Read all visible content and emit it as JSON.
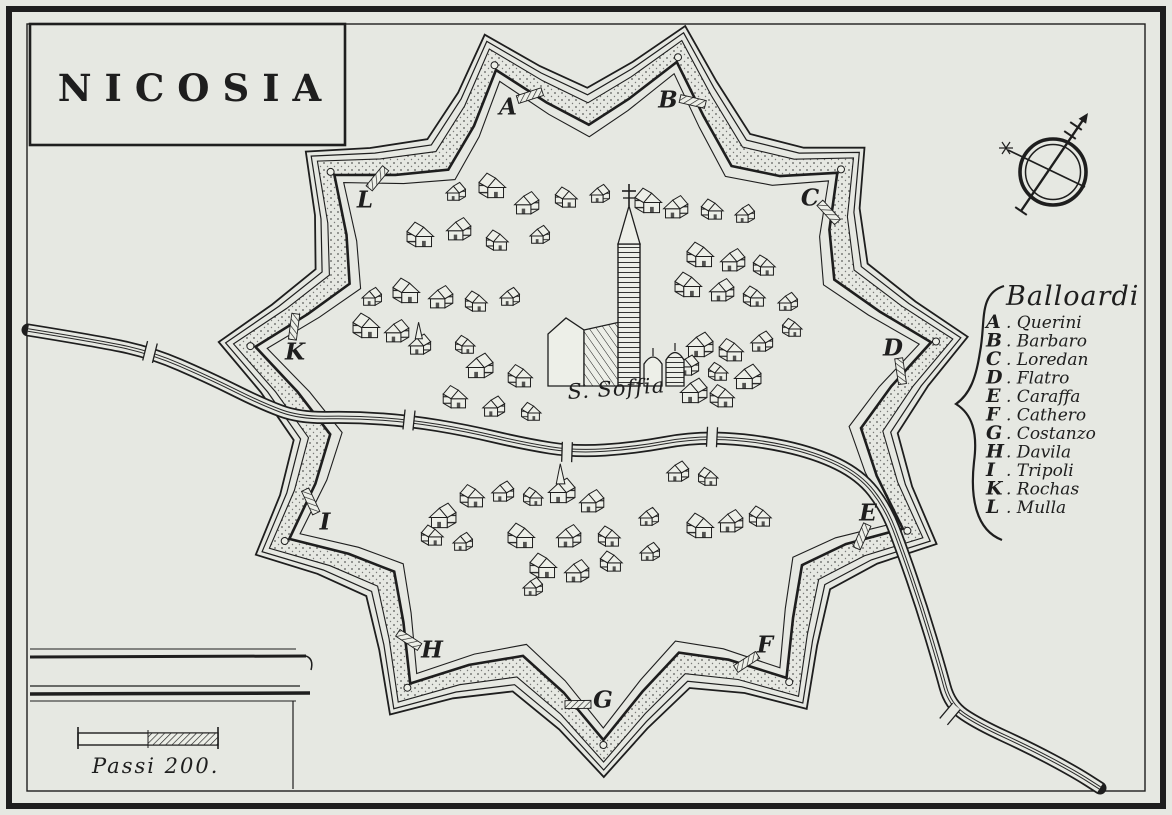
{
  "map_title": "NICOSIA",
  "cathedral_label": "S. Soffia",
  "scale_bar": {
    "label": "Passi 200."
  },
  "legend": {
    "title": "Balloardi",
    "entries": [
      {
        "letter": "A",
        "name": "Querini"
      },
      {
        "letter": "B",
        "name": "Barbaro"
      },
      {
        "letter": "C",
        "name": "Loredan"
      },
      {
        "letter": "D",
        "name": "Flatro"
      },
      {
        "letter": "E",
        "name": "Caraffa"
      },
      {
        "letter": "F",
        "name": "Cathero"
      },
      {
        "letter": "G",
        "name": "Costanzo"
      },
      {
        "letter": "H",
        "name": "Davila"
      },
      {
        "letter": "I",
        "name": "Tripoli"
      },
      {
        "letter": "K",
        "name": "Rochas"
      },
      {
        "letter": "L",
        "name": "Mulla"
      }
    ]
  },
  "bastions": [
    {
      "letter": "A",
      "x": 508,
      "y": 107
    },
    {
      "letter": "B",
      "x": 668,
      "y": 100
    },
    {
      "letter": "C",
      "x": 810,
      "y": 198
    },
    {
      "letter": "D",
      "x": 893,
      "y": 348
    },
    {
      "letter": "E",
      "x": 868,
      "y": 513
    },
    {
      "letter": "F",
      "x": 765,
      "y": 645
    },
    {
      "letter": "G",
      "x": 603,
      "y": 700
    },
    {
      "letter": "H",
      "x": 432,
      "y": 650
    },
    {
      "letter": "I",
      "x": 325,
      "y": 522
    },
    {
      "letter": "K",
      "x": 295,
      "y": 352
    },
    {
      "letter": "L",
      "x": 365,
      "y": 200
    }
  ],
  "fort": {
    "center": {
      "x": 600,
      "y": 392
    },
    "tip_scale": 1.13,
    "shoulder": {
      "d_angle": 0.13,
      "r_factor": 0.87
    },
    "curtain_r_factor": 0.79,
    "rings": {
      "stipple": 22,
      "wall": 0,
      "inner": -12,
      "covered_way": 30,
      "glacis": 37
    }
  },
  "river": {
    "main": [
      [
        28,
        330
      ],
      [
        90,
        340
      ],
      [
        150,
        352
      ],
      [
        210,
        378
      ],
      [
        262,
        404
      ],
      [
        300,
        418
      ],
      [
        355,
        417
      ],
      [
        410,
        421
      ],
      [
        465,
        430
      ],
      [
        525,
        444
      ],
      [
        575,
        452
      ],
      [
        635,
        448
      ],
      [
        695,
        437
      ],
      [
        755,
        440
      ],
      [
        815,
        453
      ],
      [
        860,
        475
      ],
      [
        886,
        508
      ],
      [
        902,
        550
      ],
      [
        922,
        608
      ],
      [
        940,
        668
      ],
      [
        950,
        705
      ],
      [
        978,
        724
      ],
      [
        1030,
        748
      ],
      [
        1075,
        772
      ],
      [
        1100,
        788
      ]
    ],
    "bridges": [
      [
        150,
        352,
        14
      ],
      [
        409,
        420,
        6
      ],
      [
        567,
        452,
        2
      ],
      [
        712,
        437,
        3
      ],
      [
        950,
        714,
        40
      ]
    ]
  },
  "houses": [
    [
      456,
      194,
      0
    ],
    [
      492,
      189,
      1
    ],
    [
      527,
      206,
      0
    ],
    [
      566,
      200,
      1
    ],
    [
      600,
      196,
      0
    ],
    [
      648,
      204,
      1
    ],
    [
      676,
      210,
      0
    ],
    [
      712,
      212,
      1
    ],
    [
      745,
      216,
      0
    ],
    [
      420,
      238,
      1
    ],
    [
      459,
      232,
      0
    ],
    [
      497,
      243,
      1
    ],
    [
      540,
      237,
      0
    ],
    [
      700,
      258,
      1
    ],
    [
      733,
      263,
      0
    ],
    [
      764,
      268,
      1
    ],
    [
      372,
      299,
      0
    ],
    [
      406,
      294,
      1
    ],
    [
      441,
      300,
      0
    ],
    [
      476,
      304,
      1
    ],
    [
      510,
      299,
      0
    ],
    [
      688,
      288,
      1
    ],
    [
      722,
      293,
      0
    ],
    [
      754,
      299,
      1
    ],
    [
      788,
      304,
      0
    ],
    [
      366,
      329,
      1
    ],
    [
      397,
      334,
      0
    ],
    [
      420,
      347,
      2
    ],
    [
      465,
      347,
      1
    ],
    [
      700,
      348,
      0
    ],
    [
      731,
      353,
      1
    ],
    [
      762,
      344,
      0
    ],
    [
      792,
      330,
      1
    ],
    [
      480,
      369,
      0
    ],
    [
      520,
      379,
      1
    ],
    [
      688,
      368,
      0
    ],
    [
      718,
      374,
      1
    ],
    [
      748,
      380,
      0
    ],
    [
      455,
      400,
      1
    ],
    [
      494,
      409,
      0
    ],
    [
      531,
      414,
      1
    ],
    [
      694,
      394,
      0
    ],
    [
      722,
      399,
      1
    ],
    [
      678,
      474,
      0
    ],
    [
      708,
      479,
      1
    ],
    [
      443,
      519,
      0
    ],
    [
      472,
      499,
      1
    ],
    [
      503,
      494,
      0
    ],
    [
      533,
      499,
      1
    ],
    [
      562,
      494,
      2
    ],
    [
      592,
      504,
      0
    ],
    [
      432,
      538,
      1
    ],
    [
      463,
      544,
      0
    ],
    [
      521,
      539,
      1
    ],
    [
      569,
      539,
      0
    ],
    [
      609,
      539,
      1
    ],
    [
      649,
      519,
      0
    ],
    [
      543,
      569,
      1
    ],
    [
      577,
      574,
      0
    ],
    [
      611,
      564,
      1
    ],
    [
      650,
      554,
      0
    ],
    [
      700,
      529,
      1
    ],
    [
      731,
      524,
      0
    ],
    [
      760,
      519,
      1
    ],
    [
      533,
      589,
      0
    ]
  ],
  "colors": {
    "paper": "#e6e8e2",
    "paper_light": "#edefe8",
    "ink": "#1e1e1e"
  }
}
